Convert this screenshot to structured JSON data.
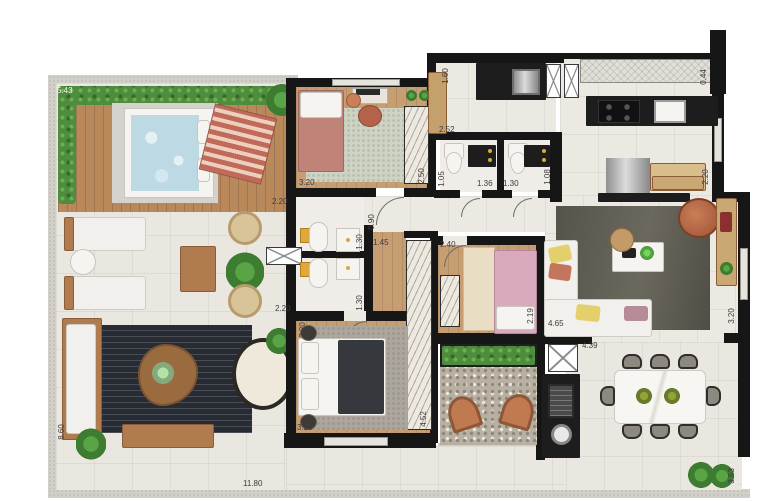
{
  "plan_type": "apartment-floor-plan",
  "colors": {
    "wall": "#161616",
    "tile_floor": "#ece9e3",
    "wood_floor": "#c79e72",
    "hedge_green": "#4e8c3e",
    "water_blue": "#bdd9e3",
    "terracotta": "#b56548",
    "dark_rug": "#272b33",
    "living_rug": "#5c594f"
  },
  "dimensions": [
    {
      "id": "terrace-top-width",
      "text": "5.43"
    },
    {
      "id": "laundry-cabinet-depth",
      "text": "1.60"
    },
    {
      "id": "kitchen-ledge",
      "text": "0.44"
    },
    {
      "id": "bedroom1-width",
      "text": "3.20"
    },
    {
      "id": "bedroom1-wardrobe",
      "text": "2.50"
    },
    {
      "id": "laundry-width",
      "text": "2.52"
    },
    {
      "id": "bath-c-depth",
      "text": "1.05"
    },
    {
      "id": "bath-c-width",
      "text": "1.36"
    },
    {
      "id": "bath-d-width",
      "text": "1.30"
    },
    {
      "id": "bath-d-depth",
      "text": "1.08"
    },
    {
      "id": "kitchen-counter-right",
      "text": "2.20"
    },
    {
      "id": "hall-top-width",
      "text": "2.20"
    },
    {
      "id": "hall-passage",
      "text": "0.90"
    },
    {
      "id": "bath-a-depth",
      "text": "1.30"
    },
    {
      "id": "corridor-width",
      "text": "1.45"
    },
    {
      "id": "bedroom2-width",
      "text": "2.40"
    },
    {
      "id": "bedroom2-depth",
      "text": "2.19"
    },
    {
      "id": "living-sofa-width",
      "text": "4.65"
    },
    {
      "id": "living-depth",
      "text": "3.20"
    },
    {
      "id": "bath-b-depth",
      "text": "1.30"
    },
    {
      "id": "bath-b-width",
      "text": "2.20"
    },
    {
      "id": "master-left-depth",
      "text": "2.20"
    },
    {
      "id": "living-bottom-width",
      "text": "4.39"
    },
    {
      "id": "master-width",
      "text": "3.20"
    },
    {
      "id": "master-wardrobe",
      "text": "4.52"
    },
    {
      "id": "terrace-left-depth",
      "text": "8.60"
    },
    {
      "id": "terrace-bottom-width",
      "text": "11.80"
    },
    {
      "id": "dining-right-depth",
      "text": "3.53"
    }
  ]
}
